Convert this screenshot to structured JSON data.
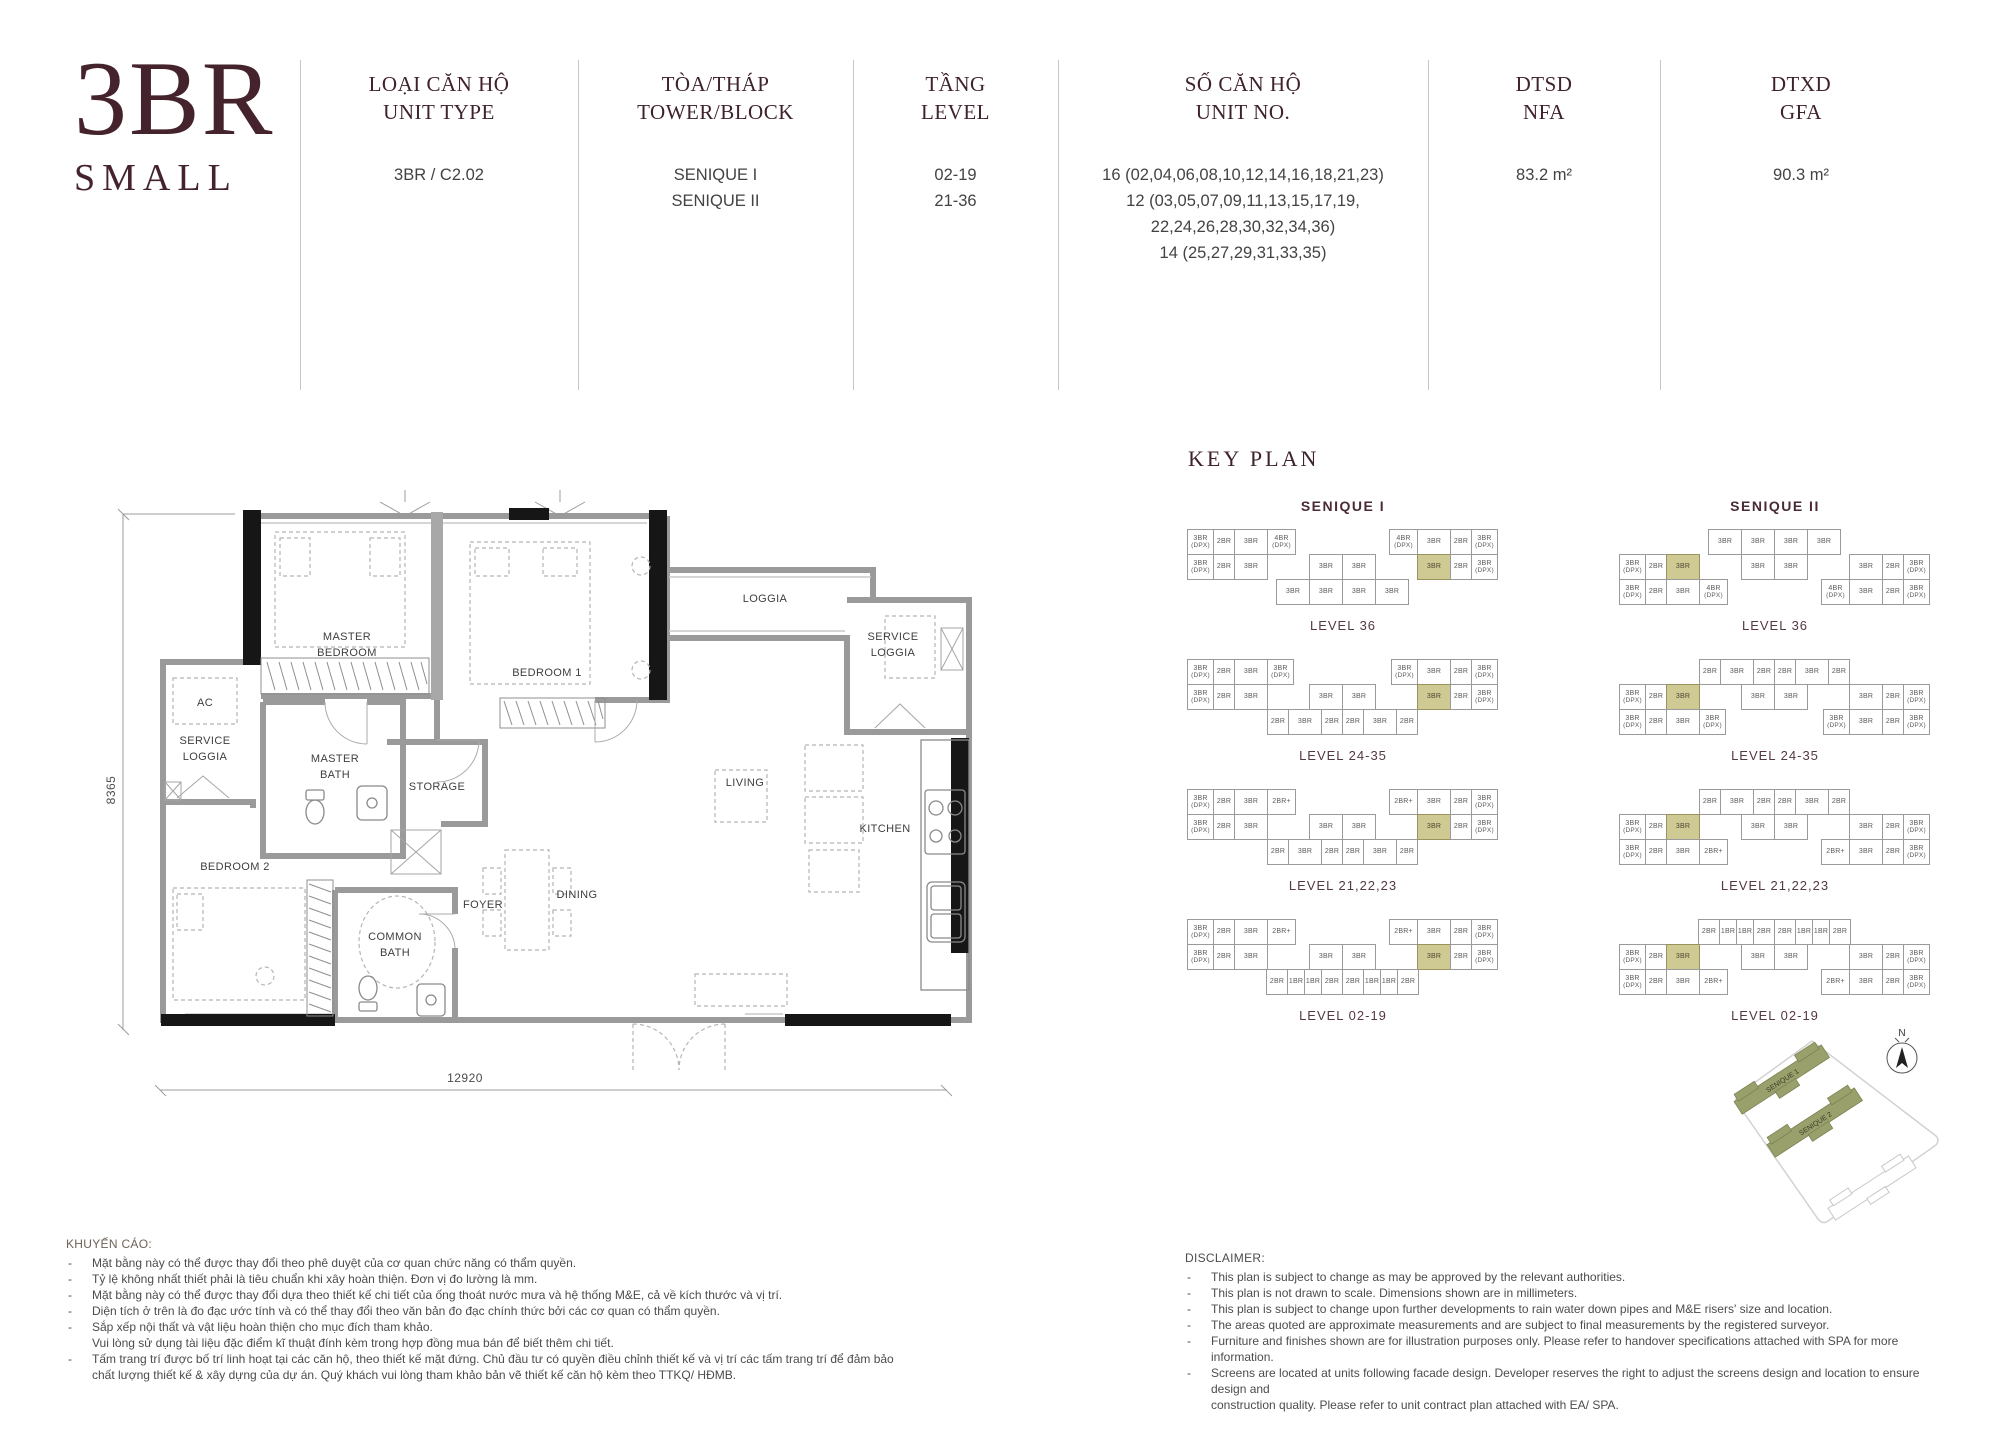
{
  "brand": {
    "line1": "3BR",
    "line2": "SMALL"
  },
  "header": {
    "columns": [
      {
        "id": "unit_type",
        "label_vi": "LOẠI CĂN HỘ",
        "label_en": "UNIT TYPE",
        "values": [
          "3BR / C2.02"
        ]
      },
      {
        "id": "tower",
        "label_vi": "TÒA/THÁP",
        "label_en": "TOWER/BLOCK",
        "values": [
          "SENIQUE I",
          "SENIQUE II"
        ]
      },
      {
        "id": "level",
        "label_vi": "TẦNG",
        "label_en": "LEVEL",
        "values": [
          "02-19",
          "21-36"
        ]
      },
      {
        "id": "unit_no",
        "label_vi": "SỐ CĂN HỘ",
        "label_en": "UNIT NO.",
        "values": [
          "16 (02,04,06,08,10,12,14,16,18,21,23)",
          "12 (03,05,07,09,11,13,15,17,19,",
          "22,24,26,28,30,32,34,36)",
          "14 (25,27,29,31,33,35)"
        ]
      },
      {
        "id": "nfa",
        "label_vi": "DTSD",
        "label_en": "NFA",
        "values": [
          "83.2 m²"
        ]
      },
      {
        "id": "gfa",
        "label_vi": "DTXD",
        "label_en": "GFA",
        "values": [
          "90.3 m²"
        ]
      }
    ]
  },
  "floorplan": {
    "dim_height": "8365",
    "dim_width": "12920",
    "rooms": {
      "master_bedroom": [
        "MASTER",
        "BEDROOM"
      ],
      "bedroom1": [
        "BEDROOM 1"
      ],
      "bedroom2": [
        "BEDROOM 2"
      ],
      "loggia": [
        "LOGGIA"
      ],
      "service_loggia_left": [
        "SERVICE",
        "LOGGIA"
      ],
      "service_loggia_right": [
        "SERVICE",
        "LOGGIA"
      ],
      "ac": [
        "AC"
      ],
      "master_bath": [
        "MASTER",
        "BATH"
      ],
      "common_bath": [
        "COMMON",
        "BATH"
      ],
      "storage": [
        "STORAGE"
      ],
      "living": [
        "LIVING"
      ],
      "kitchen": [
        "KITCHEN"
      ],
      "dining": [
        "DINING"
      ],
      "foyer": [
        "FOYER"
      ]
    }
  },
  "key_plan": {
    "title": "KEY PLAN",
    "towers": [
      {
        "name": "SENIQUE I",
        "type": "A",
        "levels": [
          {
            "label": "LEVEL 36",
            "wingL": [
              "3BR(DPX)",
              "2BR",
              "3BR",
              "4BR(DPX)"
            ],
            "wingR": [
              "4BR(DPX)",
              "3BR",
              "2BR",
              "3BR(DPX)"
            ],
            "midL": [
              "3BR(DPX)",
              "2BR",
              "3BR"
            ],
            "midC": [
              "3BR",
              "3BR"
            ],
            "midR": [
              "3BR*",
              "2BR",
              "3BR(DPX)"
            ],
            "band": [
              "3BR",
              "3BR",
              "3BR",
              "3BR"
            ]
          },
          {
            "label": "LEVEL 24-35",
            "wingL": [
              "3BR(DPX)",
              "2BR",
              "3BR",
              "3BR(DPX)"
            ],
            "wingR": [
              "3BR(DPX)",
              "3BR",
              "2BR",
              "3BR(DPX)"
            ],
            "midL": [
              "3BR(DPX)",
              "2BR",
              "3BR"
            ],
            "midC": [
              "3BR",
              "3BR"
            ],
            "midR": [
              "3BR*",
              "2BR",
              "3BR(DPX)"
            ],
            "band": [
              "2BR",
              "3BR",
              "2BR",
              "2BR",
              "3BR",
              "2BR"
            ]
          },
          {
            "label": "LEVEL 21,22,23",
            "wingL": [
              "3BR(DPX)",
              "2BR",
              "3BR",
              "2BR+"
            ],
            "wingR": [
              "2BR+",
              "3BR",
              "2BR",
              "3BR(DPX)"
            ],
            "midL": [
              "3BR(DPX)",
              "2BR",
              "3BR"
            ],
            "midC": [
              "3BR",
              "3BR"
            ],
            "midR": [
              "3BR*",
              "2BR",
              "3BR(DPX)"
            ],
            "band": [
              "2BR",
              "3BR",
              "2BR",
              "2BR",
              "3BR",
              "2BR"
            ]
          },
          {
            "label": "LEVEL 02-19",
            "wingL": [
              "3BR(DPX)",
              "2BR",
              "3BR",
              "2BR+"
            ],
            "wingR": [
              "2BR+",
              "3BR",
              "2BR",
              "3BR(DPX)"
            ],
            "midL": [
              "3BR(DPX)",
              "2BR",
              "3BR"
            ],
            "midC": [
              "3BR",
              "3BR"
            ],
            "midR": [
              "3BR*",
              "2BR",
              "3BR(DPX)"
            ],
            "band": [
              "2BR",
              "1BR",
              "1BR",
              "2BR",
              "2BR",
              "1BR",
              "1BR",
              "2BR"
            ]
          }
        ]
      },
      {
        "name": "SENIQUE II",
        "type": "B",
        "levels": [
          {
            "label": "LEVEL 36",
            "band": [
              "3BR",
              "3BR",
              "3BR",
              "3BR"
            ],
            "midL": [
              "3BR(DPX)",
              "2BR",
              "3BR*"
            ],
            "midC": [
              "3BR",
              "3BR"
            ],
            "midR": [
              "3BR",
              "2BR",
              "3BR(DPX)"
            ],
            "wingL": [
              "3BR(DPX)",
              "2BR",
              "3BR",
              "4BR(DPX)"
            ],
            "wingR": [
              "4BR(DPX)",
              "3BR",
              "2BR",
              "3BR(DPX)"
            ]
          },
          {
            "label": "LEVEL 24-35",
            "band": [
              "2BR",
              "3BR",
              "2BR",
              "2BR",
              "3BR",
              "2BR"
            ],
            "midL": [
              "3BR(DPX)",
              "2BR",
              "3BR*"
            ],
            "midC": [
              "3BR",
              "3BR"
            ],
            "midR": [
              "3BR",
              "2BR",
              "3BR(DPX)"
            ],
            "wingL": [
              "3BR(DPX)",
              "2BR",
              "3BR",
              "3BR(DPX)"
            ],
            "wingR": [
              "3BR(DPX)",
              "3BR",
              "2BR",
              "3BR(DPX)"
            ]
          },
          {
            "label": "LEVEL 21,22,23",
            "band": [
              "2BR",
              "3BR",
              "2BR",
              "2BR",
              "3BR",
              "2BR"
            ],
            "midL": [
              "3BR(DPX)",
              "2BR",
              "3BR*"
            ],
            "midC": [
              "3BR",
              "3BR"
            ],
            "midR": [
              "3BR",
              "2BR",
              "3BR(DPX)"
            ],
            "wingL": [
              "3BR(DPX)",
              "2BR",
              "3BR",
              "2BR+"
            ],
            "wingR": [
              "2BR+",
              "3BR",
              "2BR",
              "3BR(DPX)"
            ]
          },
          {
            "label": "LEVEL 02-19",
            "band": [
              "2BR",
              "1BR",
              "1BR",
              "2BR",
              "2BR",
              "1BR",
              "1BR",
              "2BR"
            ],
            "midL": [
              "3BR(DPX)",
              "2BR",
              "3BR*"
            ],
            "midC": [
              "3BR",
              "3BR"
            ],
            "midR": [
              "3BR",
              "2BR",
              "3BR(DPX)"
            ],
            "wingL": [
              "3BR(DPX)",
              "2BR",
              "3BR",
              "2BR+"
            ],
            "wingR": [
              "2BR+",
              "3BR",
              "2BR",
              "3BR(DPX)"
            ]
          }
        ]
      }
    ]
  },
  "site_map": {
    "building_1": "SENIQUE 1",
    "building_2": "SENIQUE 2",
    "north": "N"
  },
  "notices": {
    "vi": {
      "title": "KHUYẾN CÁO:",
      "lines": [
        {
          "b": true,
          "t": "Mặt bằng này có thể được thay đổi theo phê duyệt của cơ quan chức năng có thẩm quyền."
        },
        {
          "b": true,
          "t": "Tỷ lệ không nhất thiết phải là tiêu chuẩn khi xây hoàn thiện. Đơn vị đo lường là mm."
        },
        {
          "b": true,
          "t": "Mặt bằng này có thể được thay đổi dựa theo thiết kế chi tiết của ống thoát nước mưa và hệ thống M&E, cả về kích thước và vị trí."
        },
        {
          "b": true,
          "t": "Diện tích ở trên là đo đạc ước tính và có thể thay đổi theo văn bản đo đạc chính thức bởi các cơ quan có thẩm quyền."
        },
        {
          "b": true,
          "t": "Sắp xếp nội thất và vật liệu hoàn thiện cho mục đích tham khảo."
        },
        {
          "b": false,
          "t": "Vui lòng sử dụng tài liệu đặc điểm kĩ thuật đính kèm trong hợp đồng mua bán để biết thêm chi tiết."
        },
        {
          "b": true,
          "t": "Tấm trang trí được bố trí linh hoạt tại các căn hộ, theo thiết kế mặt đứng. Chủ đầu tư có quyền điều chỉnh thiết kế và vị trí các tấm trang trí để đảm bảo"
        },
        {
          "b": false,
          "t": "chất lượng thiết kế & xây dựng của dự án. Quý khách vui lòng tham khảo bản vẽ thiết kế căn hộ kèm theo TTKQ/ HĐMB."
        }
      ]
    },
    "en": {
      "title": "DISCLAIMER:",
      "lines": [
        {
          "b": true,
          "t": "This plan is subject to change as may be approved by the relevant authorities."
        },
        {
          "b": true,
          "t": "This plan is not drawn to scale. Dimensions shown are in millimeters."
        },
        {
          "b": true,
          "t": "This plan is subject to change upon further developments to rain water down pipes and M&E risers' size and location."
        },
        {
          "b": true,
          "t": "The areas quoted are approximate measurements and are subject to final measurements by the registered surveyor."
        },
        {
          "b": true,
          "t": "Furniture and finishes shown are for illustration purposes only. Please refer to handover specifications attached with SPA for more information."
        },
        {
          "b": true,
          "t": "Screens are located at units following facade design. Developer reserves the right to adjust the screens design and location to ensure design and"
        },
        {
          "b": false,
          "t": "construction quality. Please refer to unit contract plan attached with EA/ SPA."
        }
      ]
    }
  },
  "colors": {
    "maroon": "#44232c",
    "highlight": "#cfc993",
    "highlight_border": "#9b935b",
    "wall_gray": "#9a9a9a",
    "wall_black": "#161616",
    "olive_site": "#9aa06b"
  }
}
